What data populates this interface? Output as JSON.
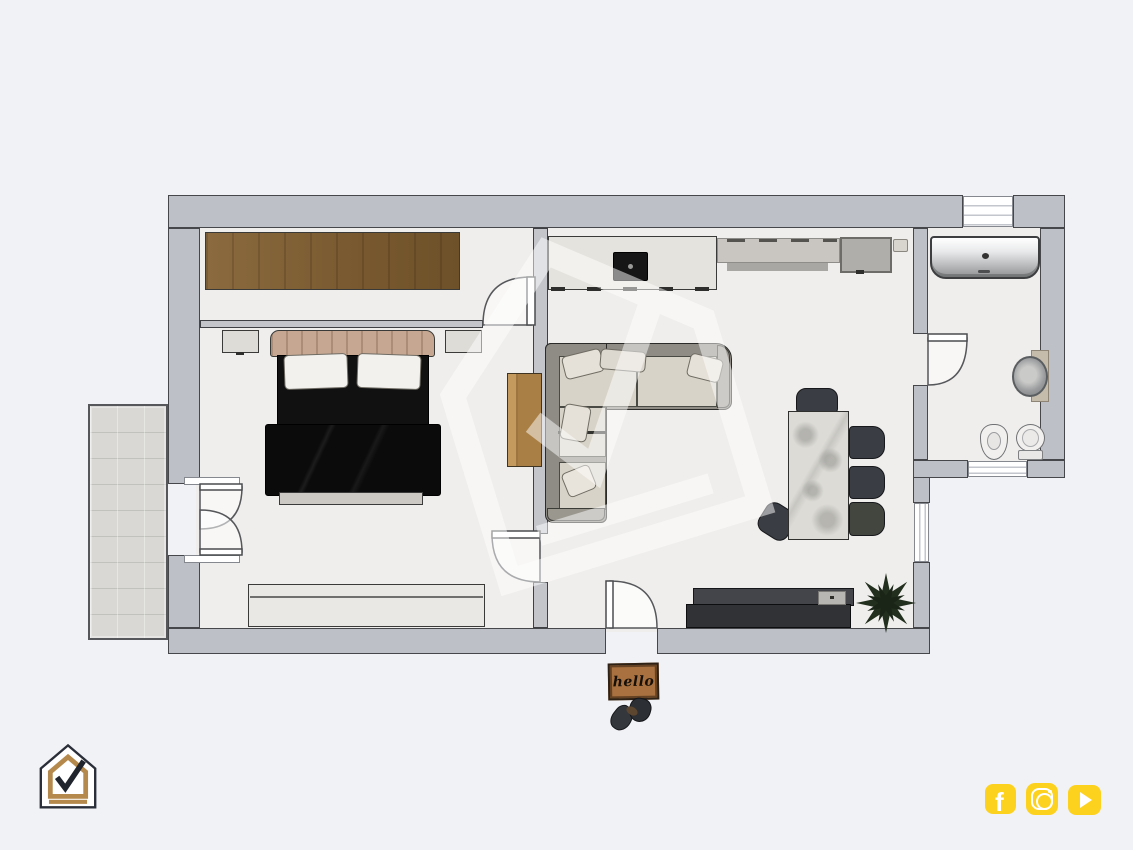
{
  "page": {
    "background_color": "#f1f2f6",
    "description": "3D rendered top-down floor plan of a one-bedroom apartment"
  },
  "plan": {
    "wall_fill": "#bdc0c7",
    "wall_outline": "#45474b",
    "floor_fill": "#efeeec",
    "balcony_tile_fill": "#d9d8d4",
    "rooms": [
      {
        "name": "dressing-area",
        "furniture": [
          "brown wardrobe"
        ]
      },
      {
        "name": "bedroom",
        "furniture": [
          "double bed with black duvet",
          "nightstand left",
          "nightstand right",
          "low dresser",
          "wood desk"
        ]
      },
      {
        "name": "living-kitchen",
        "furniture": [
          "kitchen counter with cooktop",
          "upper cabinet run",
          "tall fridge cabinet",
          "corner sofa",
          "marble dining island",
          "five charcoal chairs",
          "tv sideboard",
          "potted plant"
        ]
      },
      {
        "name": "bathroom",
        "furniture": [
          "bathtub",
          "washing machine",
          "bidet",
          "toilet"
        ]
      },
      {
        "name": "balcony",
        "furniture": []
      }
    ],
    "doors": [
      "entry-door",
      "bedroom-door",
      "closet-door",
      "bathroom-door",
      "balcony-french-doors"
    ],
    "windows": [
      "top-window",
      "east-window",
      "bathroom-south-window"
    ]
  },
  "doormat": {
    "text": "hello",
    "fill": "#a8713f",
    "text_color": "#171009"
  },
  "logo": {
    "name": "house-checkmark-logo",
    "gold": "#b5894b",
    "outline_color": "#2a2e38",
    "check_color": "#20242c"
  },
  "watermark": {
    "name": "house-checkmark-watermark",
    "color": "#ffffff",
    "opacity": 0.5
  },
  "social": {
    "accent": "#fdd21e",
    "facebook_glyph": "f",
    "icons": [
      {
        "name": "facebook-icon"
      },
      {
        "name": "instagram-icon"
      },
      {
        "name": "youtube-icon"
      }
    ]
  }
}
